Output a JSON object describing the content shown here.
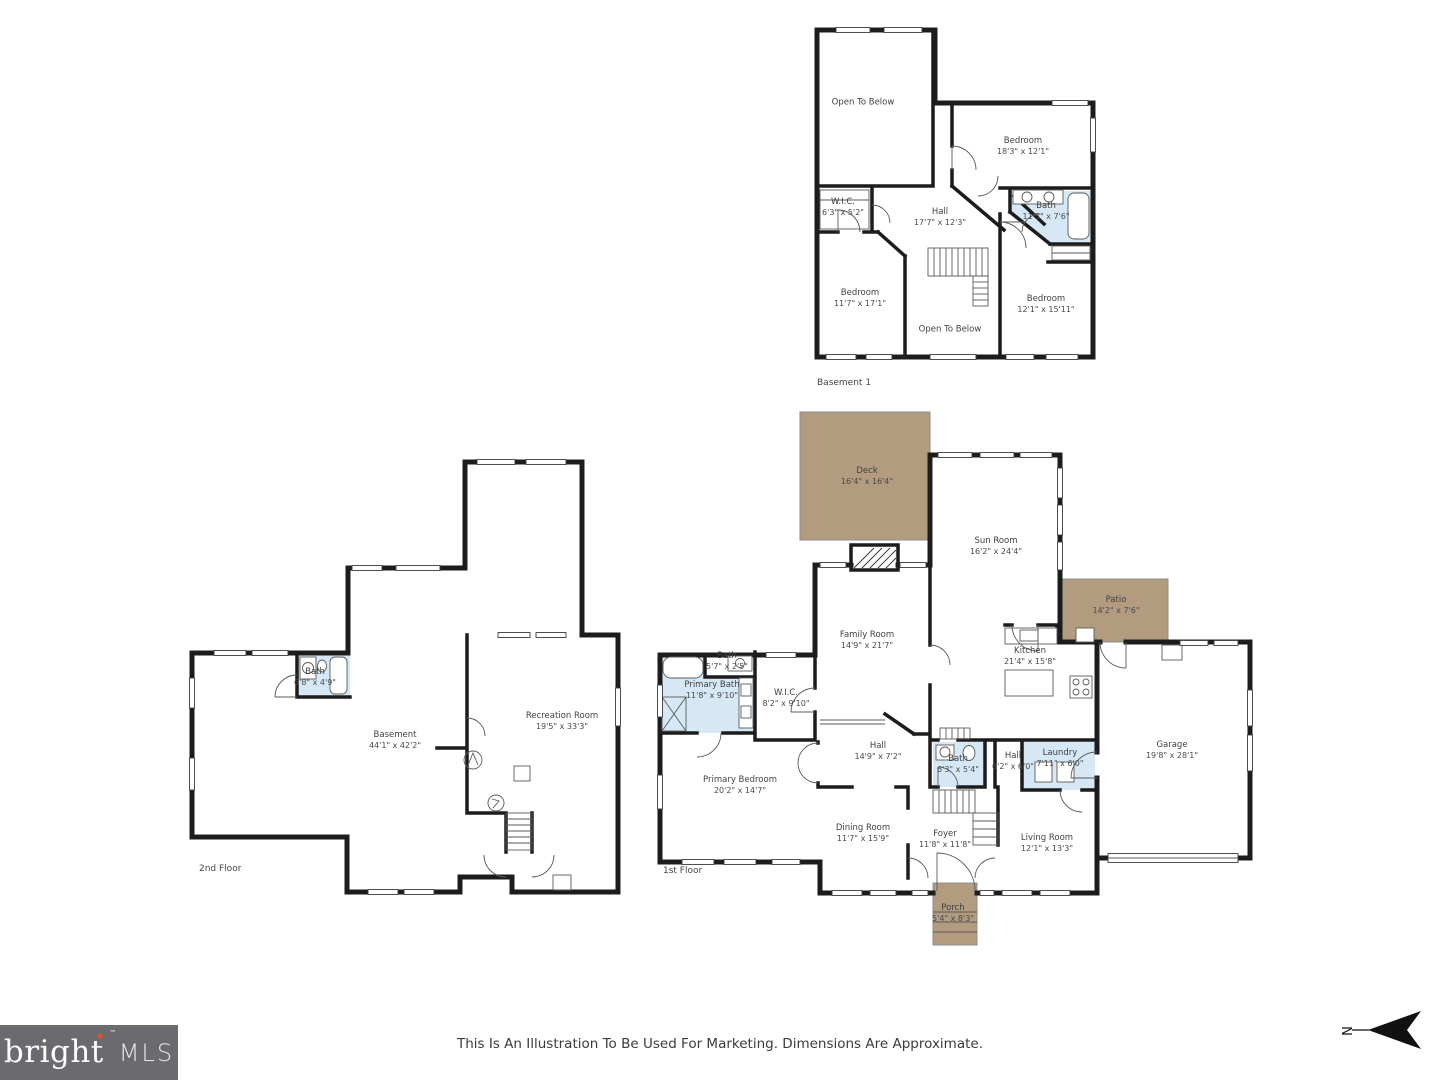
{
  "footer": {
    "disclaimer": "This Is An Illustration To Be Used For Marketing. Dimensions Are Approximate.",
    "logo": {
      "brand": "bright",
      "star_glyph": "✦",
      "tm": "™",
      "suffix": "MLS"
    },
    "compass": {
      "letter": "N"
    }
  },
  "colors": {
    "wall": "#1c1c1c",
    "bath_fill": "#d6e8f5",
    "wood_fill": "#b39b80",
    "logo_bg": "#6b6a6e",
    "logo_star": "#e2512d"
  },
  "floors": [
    {
      "label": "Basement 1",
      "x": 817,
      "y": 378
    },
    {
      "label": "2nd Floor",
      "x": 199,
      "y": 864
    },
    {
      "label": "1st Floor",
      "x": 663,
      "y": 866
    }
  ],
  "rooms": [
    {
      "floor": "Basement 1",
      "name": "Open To Below",
      "dims": "",
      "x": 863,
      "y": 103
    },
    {
      "floor": "Basement 1",
      "name": "Bedroom",
      "dims": "18'3\" x 12'1\"",
      "x": 1023,
      "y": 147
    },
    {
      "floor": "Basement 1",
      "name": "W.I.C.",
      "dims": "6'3\" x 5'2\"",
      "x": 843,
      "y": 208
    },
    {
      "floor": "Basement 1",
      "name": "Hall",
      "dims": "17'7\" x 12'3\"",
      "x": 940,
      "y": 218
    },
    {
      "floor": "Basement 1",
      "name": "Bath",
      "dims": "11'5\" x 7'6\"",
      "x": 1046,
      "y": 212
    },
    {
      "floor": "Basement 1",
      "name": "Bedroom",
      "dims": "11'7\" x 17'1\"",
      "x": 860,
      "y": 299
    },
    {
      "floor": "Basement 1",
      "name": "Open To Below",
      "dims": "",
      "x": 950,
      "y": 330
    },
    {
      "floor": "Basement 1",
      "name": "Bedroom",
      "dims": "12'1\" x 15'11\"",
      "x": 1046,
      "y": 305
    },
    {
      "floor": "2nd Floor",
      "name": "Bath",
      "dims": "6'8\" x 4'9\"",
      "x": 315,
      "y": 678
    },
    {
      "floor": "2nd Floor",
      "name": "Basement",
      "dims": "44'1\" x 42'2\"",
      "x": 395,
      "y": 741
    },
    {
      "floor": "2nd Floor",
      "name": "Recreation Room",
      "dims": "19'5\" x 33'3\"",
      "x": 562,
      "y": 722
    },
    {
      "floor": "1st Floor",
      "name": "Deck",
      "dims": "16'4\" x 16'4\"",
      "x": 867,
      "y": 477
    },
    {
      "floor": "1st Floor",
      "name": "Sun Room",
      "dims": "16'2\" x 24'4\"",
      "x": 996,
      "y": 547
    },
    {
      "floor": "1st Floor",
      "name": "Patio",
      "dims": "14'2\" x 7'6\"",
      "x": 1116,
      "y": 606
    },
    {
      "floor": "1st Floor",
      "name": "Family Room",
      "dims": "14'9\" x 21'7\"",
      "x": 867,
      "y": 641
    },
    {
      "floor": "1st Floor",
      "name": "Kitchen",
      "dims": "21'4\" x 15'8\"",
      "x": 1030,
      "y": 657
    },
    {
      "floor": "1st Floor",
      "name": "Bath",
      "dims": "5'7\" x 2'5\"",
      "x": 727,
      "y": 662
    },
    {
      "floor": "1st Floor",
      "name": "Primary Bath",
      "dims": "11'8\" x 9'10\"",
      "x": 712,
      "y": 691
    },
    {
      "floor": "1st Floor",
      "name": "W.I.C.",
      "dims": "8'2\" x 9'10\"",
      "x": 786,
      "y": 699
    },
    {
      "floor": "1st Floor",
      "name": "Garage",
      "dims": "19'8\" x 28'1\"",
      "x": 1172,
      "y": 751
    },
    {
      "floor": "1st Floor",
      "name": "Hall",
      "dims": "14'9\" x 7'2\"",
      "x": 878,
      "y": 752
    },
    {
      "floor": "1st Floor",
      "name": "Bath",
      "dims": "6'3\" x 5'4\"",
      "x": 958,
      "y": 765
    },
    {
      "floor": "1st Floor",
      "name": "Hall",
      "dims": "6'2\" x 6'0\"",
      "x": 1013,
      "y": 762
    },
    {
      "floor": "1st Floor",
      "name": "Laundry",
      "dims": "7'11\" x 6'0\"",
      "x": 1060,
      "y": 759
    },
    {
      "floor": "1st Floor",
      "name": "Primary Bedroom",
      "dims": "20'2\" x 14'7\"",
      "x": 740,
      "y": 786
    },
    {
      "floor": "1st Floor",
      "name": "Dining Room",
      "dims": "11'7\" x 15'9\"",
      "x": 863,
      "y": 834
    },
    {
      "floor": "1st Floor",
      "name": "Foyer",
      "dims": "11'8\" x 11'8\"",
      "x": 945,
      "y": 840
    },
    {
      "floor": "1st Floor",
      "name": "Living Room",
      "dims": "12'1\" x 13'3\"",
      "x": 1047,
      "y": 844
    },
    {
      "floor": "1st Floor",
      "name": "Porch",
      "dims": "5'4\" x 8'3\"",
      "x": 953,
      "y": 914
    }
  ]
}
